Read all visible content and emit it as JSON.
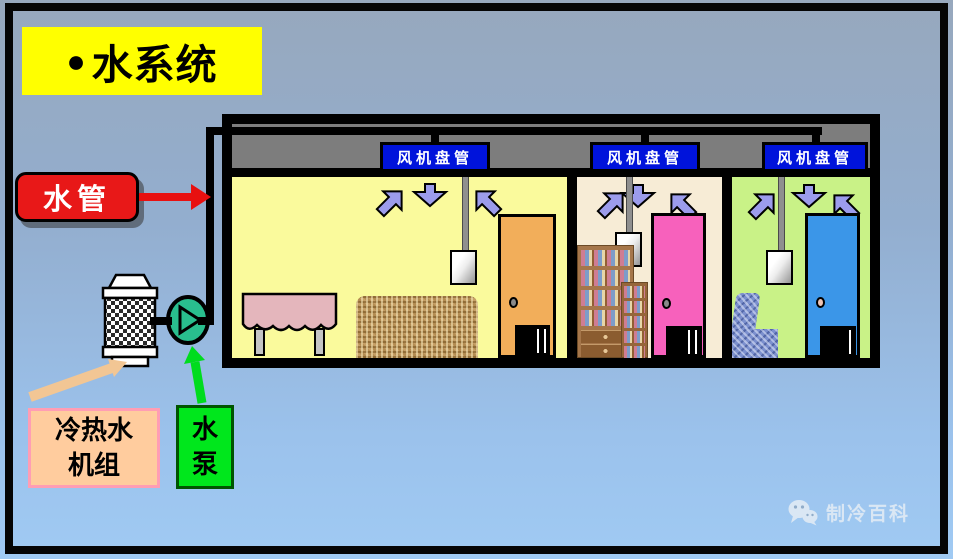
{
  "title": {
    "bullet": "●",
    "text": "水系统"
  },
  "labels": {
    "water_pipe": "水管",
    "chiller_line1": "冷热水",
    "chiller_line2": "机组",
    "pump_line1": "水",
    "pump_line2": "泵"
  },
  "building": {
    "fan_coil_units": [
      {
        "label": "风机盘管"
      },
      {
        "label": "风机盘管"
      },
      {
        "label": "风机盘管"
      }
    ],
    "rooms": [
      {
        "name": "living-room",
        "wall_color": "#FAFA9C",
        "door_color": "#F2AE5A",
        "furniture": [
          "table",
          "sofa"
        ]
      },
      {
        "name": "study-room",
        "wall_color": "#F7ECD6",
        "door_color": "#F761BC",
        "furniture": [
          "bookshelf"
        ]
      },
      {
        "name": "bedroom",
        "wall_color": "#C9F287",
        "door_color": "#3B96E8",
        "furniture": [
          "armchair"
        ]
      }
    ]
  },
  "watermark": {
    "text": "制冷百科",
    "icon": "wechat-icon"
  },
  "colors": {
    "background_top": "#97A8BD",
    "background_bottom": "#A0CAF3",
    "title_bg": "#FFFF00",
    "water_pipe_label_bg": "#E81818",
    "fan_coil_label_bg": "#0013DB",
    "plenum_gray": "#7D7D7D",
    "pipe_black": "#000000",
    "pump_symbol_green": "#29BE8E",
    "pump_label_bg": "#00E71C",
    "chiller_label_bg": "#FFCC9E",
    "chiller_label_border": "#FF9DB4",
    "airflow_arrow": "#9C9CEC",
    "pointer_arrow_green": "#00DC1E",
    "pointer_arrow_tan": "#F2C694"
  }
}
